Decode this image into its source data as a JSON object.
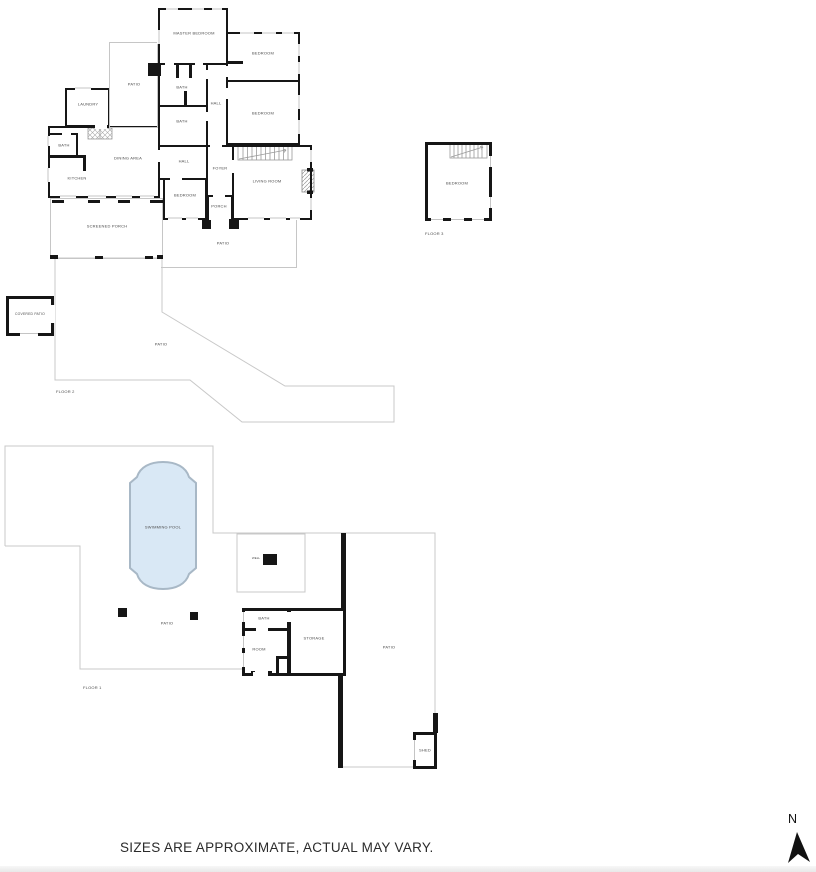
{
  "colors": {
    "wall": "#161616",
    "thin_line": "#c6c6c6",
    "pool_fill": "#d9e8f5",
    "pool_stroke": "#a8b8c6",
    "label_text": "#4a4a4a"
  },
  "floor2": {
    "name": "FLOOR 2",
    "rooms": {
      "master_bedroom": "MASTER BEDROOM",
      "bedroom_top_right": "BEDROOM",
      "bedroom_right": "BEDROOM",
      "bedroom_lower": "BEDROOM",
      "bath_upper": "BATH",
      "bath_lower": "BATH",
      "bath_left": "BATH",
      "hall_upper": "HALL",
      "hall_lower": "HALL",
      "patio_upper": "PATIO",
      "patio_mid": "PATIO",
      "patio_large": "PATIO",
      "covered_patio": "COVERED PATIO",
      "laundry": "LAUNDRY",
      "dining_area": "DINING AREA",
      "kitchen": "KITCHEN",
      "foyer": "FOYER",
      "porch": "PORCH",
      "living_room": "LIVING ROOM",
      "screened_porch": "SCREENED PORCH"
    }
  },
  "floor3": {
    "name": "FLOOR 3",
    "rooms": {
      "bedroom": "BEDROOM"
    }
  },
  "floor1": {
    "name": "FLOOR 1",
    "rooms": {
      "swimming_pool": "SWIMMING POOL",
      "patio_pool": "PATIO",
      "patio_right": "PATIO",
      "well": "WELL",
      "bath": "BATH",
      "room": "ROOM",
      "storage": "STORAGE",
      "shed": "SHED"
    }
  },
  "disclaimer": "SIZES ARE APPROXIMATE, ACTUAL MAY VARY.",
  "compass": {
    "north_label": "N"
  }
}
